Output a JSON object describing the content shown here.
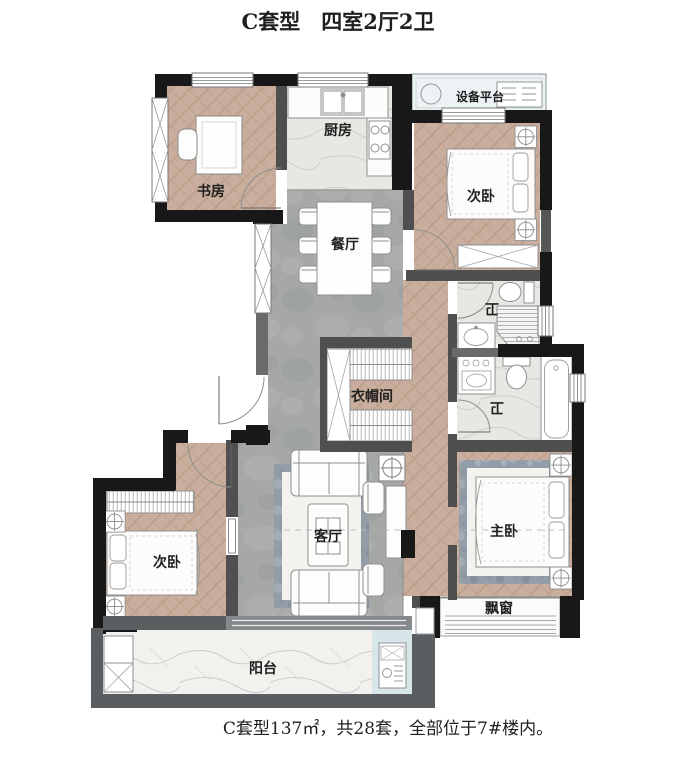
{
  "title": "C套型　四室2厅2卫",
  "caption": "C套型137㎡，共28套，全部位于7#楼内。",
  "rooms": {
    "study": "书房",
    "kitchen": "厨房",
    "equipment_platform": "设备平台",
    "bedroom_ne": "次卧",
    "dining": "餐厅",
    "bath_upper": "卫",
    "bath_lower": "卫",
    "cloakroom": "衣帽间",
    "living": "客厅",
    "bedroom_sw": "次卧",
    "master": "主卧",
    "bay_window": "飘窗",
    "balcony": "阳台"
  },
  "colors": {
    "wall": "#181818",
    "interior_wall": "#4f4f4f",
    "balcony_wall": "#5b5e60",
    "wood_floor": "#c9ae9d",
    "concrete_floor": "#a6a8a7",
    "marble_floor": "#e9e7e3",
    "balcony_floor": "#f2f1ee",
    "rug": "#939da8",
    "glazing": "#d7e6e8",
    "text": "#1f1f1f"
  }
}
